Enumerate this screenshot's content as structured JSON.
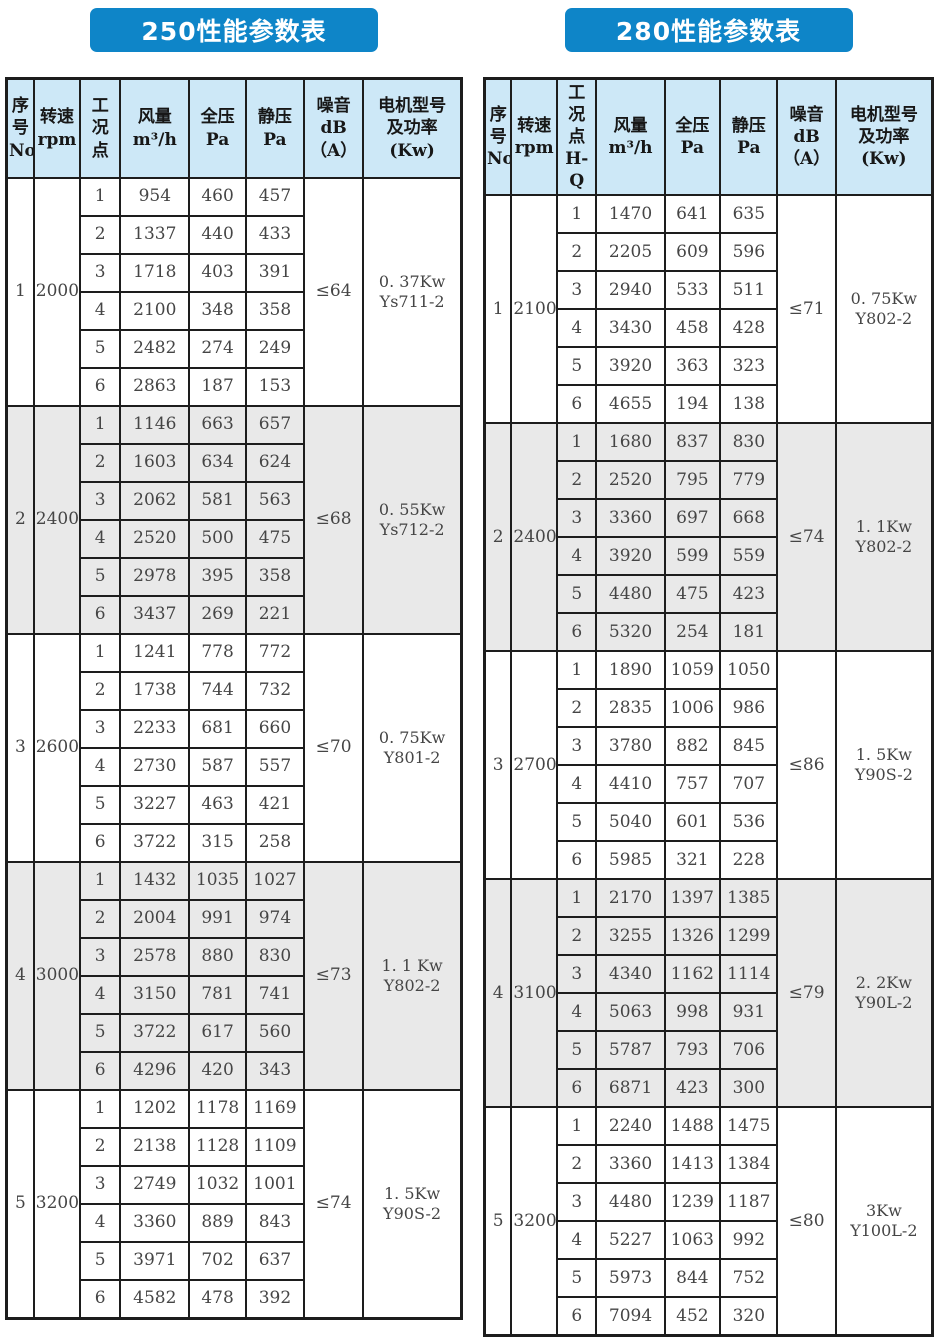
{
  "colors": {
    "title_bg": "#0e85c8",
    "title_text": "#ffffff",
    "header_bg": "#cde8f7",
    "alt_group_bg": "#e9e9e9",
    "border": "#1d1d1d"
  },
  "tables": [
    {
      "title": "250性能参数表",
      "columns": [
        "序\n号\nNo",
        "转速\nrpm",
        "工\n况\n点",
        "风量\nm³/h",
        "全压\nPa",
        "静压\nPa",
        "噪音\ndB\n（A）",
        "电机型号\n及功率\n(Kw)"
      ],
      "groups": [
        {
          "no": "1",
          "rpm": "2000",
          "noise": "≤64",
          "motor": "0. 37Kw\nYs711-2",
          "rows": [
            [
              "1",
              "954",
              "460",
              "457"
            ],
            [
              "2",
              "1337",
              "440",
              "433"
            ],
            [
              "3",
              "1718",
              "403",
              "391"
            ],
            [
              "4",
              "2100",
              "348",
              "358"
            ],
            [
              "5",
              "2482",
              "274",
              "249"
            ],
            [
              "6",
              "2863",
              "187",
              "153"
            ]
          ]
        },
        {
          "no": "2",
          "rpm": "2400",
          "noise": "≤68",
          "motor": "0. 55Kw\nYs712-2",
          "rows": [
            [
              "1",
              "1146",
              "663",
              "657"
            ],
            [
              "2",
              "1603",
              "634",
              "624"
            ],
            [
              "3",
              "2062",
              "581",
              "563"
            ],
            [
              "4",
              "2520",
              "500",
              "475"
            ],
            [
              "5",
              "2978",
              "395",
              "358"
            ],
            [
              "6",
              "3437",
              "269",
              "221"
            ]
          ]
        },
        {
          "no": "3",
          "rpm": "2600",
          "noise": "≤70",
          "motor": "0. 75Kw\nY801-2",
          "rows": [
            [
              "1",
              "1241",
              "778",
              "772"
            ],
            [
              "2",
              "1738",
              "744",
              "732"
            ],
            [
              "3",
              "2233",
              "681",
              "660"
            ],
            [
              "4",
              "2730",
              "587",
              "557"
            ],
            [
              "5",
              "3227",
              "463",
              "421"
            ],
            [
              "6",
              "3722",
              "315",
              "258"
            ]
          ]
        },
        {
          "no": "4",
          "rpm": "3000",
          "noise": "≤73",
          "motor": "1. 1 Kw\nY802-2",
          "rows": [
            [
              "1",
              "1432",
              "1035",
              "1027"
            ],
            [
              "2",
              "2004",
              "991",
              "974"
            ],
            [
              "3",
              "2578",
              "880",
              "830"
            ],
            [
              "4",
              "3150",
              "781",
              "741"
            ],
            [
              "5",
              "3722",
              "617",
              "560"
            ],
            [
              "6",
              "4296",
              "420",
              "343"
            ]
          ]
        },
        {
          "no": "5",
          "rpm": "3200",
          "noise": "≤74",
          "motor": "1. 5Kw\nY90S-2",
          "rows": [
            [
              "1",
              "1202",
              "1178",
              "1169"
            ],
            [
              "2",
              "2138",
              "1128",
              "1109"
            ],
            [
              "3",
              "2749",
              "1032",
              "1001"
            ],
            [
              "4",
              "3360",
              "889",
              "843"
            ],
            [
              "5",
              "3971",
              "702",
              "637"
            ],
            [
              "6",
              "4582",
              "478",
              "392"
            ]
          ]
        }
      ]
    },
    {
      "title": "280性能参数表",
      "columns": [
        "序\n号\nNo",
        "转速\nrpm",
        "工\n况\n点\nH-Q",
        "风量\nm³/h",
        "全压\nPa",
        "静压\nPa",
        "噪音\ndB\n（A）",
        "电机型号\n及功率\n(Kw)"
      ],
      "groups": [
        {
          "no": "1",
          "rpm": "2100",
          "noise": "≤71",
          "motor": "0. 75Kw\nY802-2",
          "rows": [
            [
              "1",
              "1470",
              "641",
              "635"
            ],
            [
              "2",
              "2205",
              "609",
              "596"
            ],
            [
              "3",
              "2940",
              "533",
              "511"
            ],
            [
              "4",
              "3430",
              "458",
              "428"
            ],
            [
              "5",
              "3920",
              "363",
              "323"
            ],
            [
              "6",
              "4655",
              "194",
              "138"
            ]
          ]
        },
        {
          "no": "2",
          "rpm": "2400",
          "noise": "≤74",
          "motor": "1. 1Kw\nY802-2",
          "rows": [
            [
              "1",
              "1680",
              "837",
              "830"
            ],
            [
              "2",
              "2520",
              "795",
              "779"
            ],
            [
              "3",
              "3360",
              "697",
              "668"
            ],
            [
              "4",
              "3920",
              "599",
              "559"
            ],
            [
              "5",
              "4480",
              "475",
              "423"
            ],
            [
              "6",
              "5320",
              "254",
              "181"
            ]
          ]
        },
        {
          "no": "3",
          "rpm": "2700",
          "noise": "≤86",
          "motor": "1. 5Kw\nY90S-2",
          "rows": [
            [
              "1",
              "1890",
              "1059",
              "1050"
            ],
            [
              "2",
              "2835",
              "1006",
              "986"
            ],
            [
              "3",
              "3780",
              "882",
              "845"
            ],
            [
              "4",
              "4410",
              "757",
              "707"
            ],
            [
              "5",
              "5040",
              "601",
              "536"
            ],
            [
              "6",
              "5985",
              "321",
              "228"
            ]
          ]
        },
        {
          "no": "4",
          "rpm": "3100",
          "noise": "≤79",
          "motor": "2. 2Kw\nY90L-2",
          "rows": [
            [
              "1",
              "2170",
              "1397",
              "1385"
            ],
            [
              "2",
              "3255",
              "1326",
              "1299"
            ],
            [
              "3",
              "4340",
              "1162",
              "1114"
            ],
            [
              "4",
              "5063",
              "998",
              "931"
            ],
            [
              "5",
              "5787",
              "793",
              "706"
            ],
            [
              "6",
              "6871",
              "423",
              "300"
            ]
          ]
        },
        {
          "no": "5",
          "rpm": "3200",
          "noise": "≤80",
          "motor": "3Kw\nY100L-2",
          "rows": [
            [
              "1",
              "2240",
              "1488",
              "1475"
            ],
            [
              "2",
              "3360",
              "1413",
              "1384"
            ],
            [
              "3",
              "4480",
              "1239",
              "1187"
            ],
            [
              "4",
              "5227",
              "1063",
              "992"
            ],
            [
              "5",
              "5973",
              "844",
              "752"
            ],
            [
              "6",
              "7094",
              "452",
              "320"
            ]
          ]
        }
      ]
    }
  ]
}
